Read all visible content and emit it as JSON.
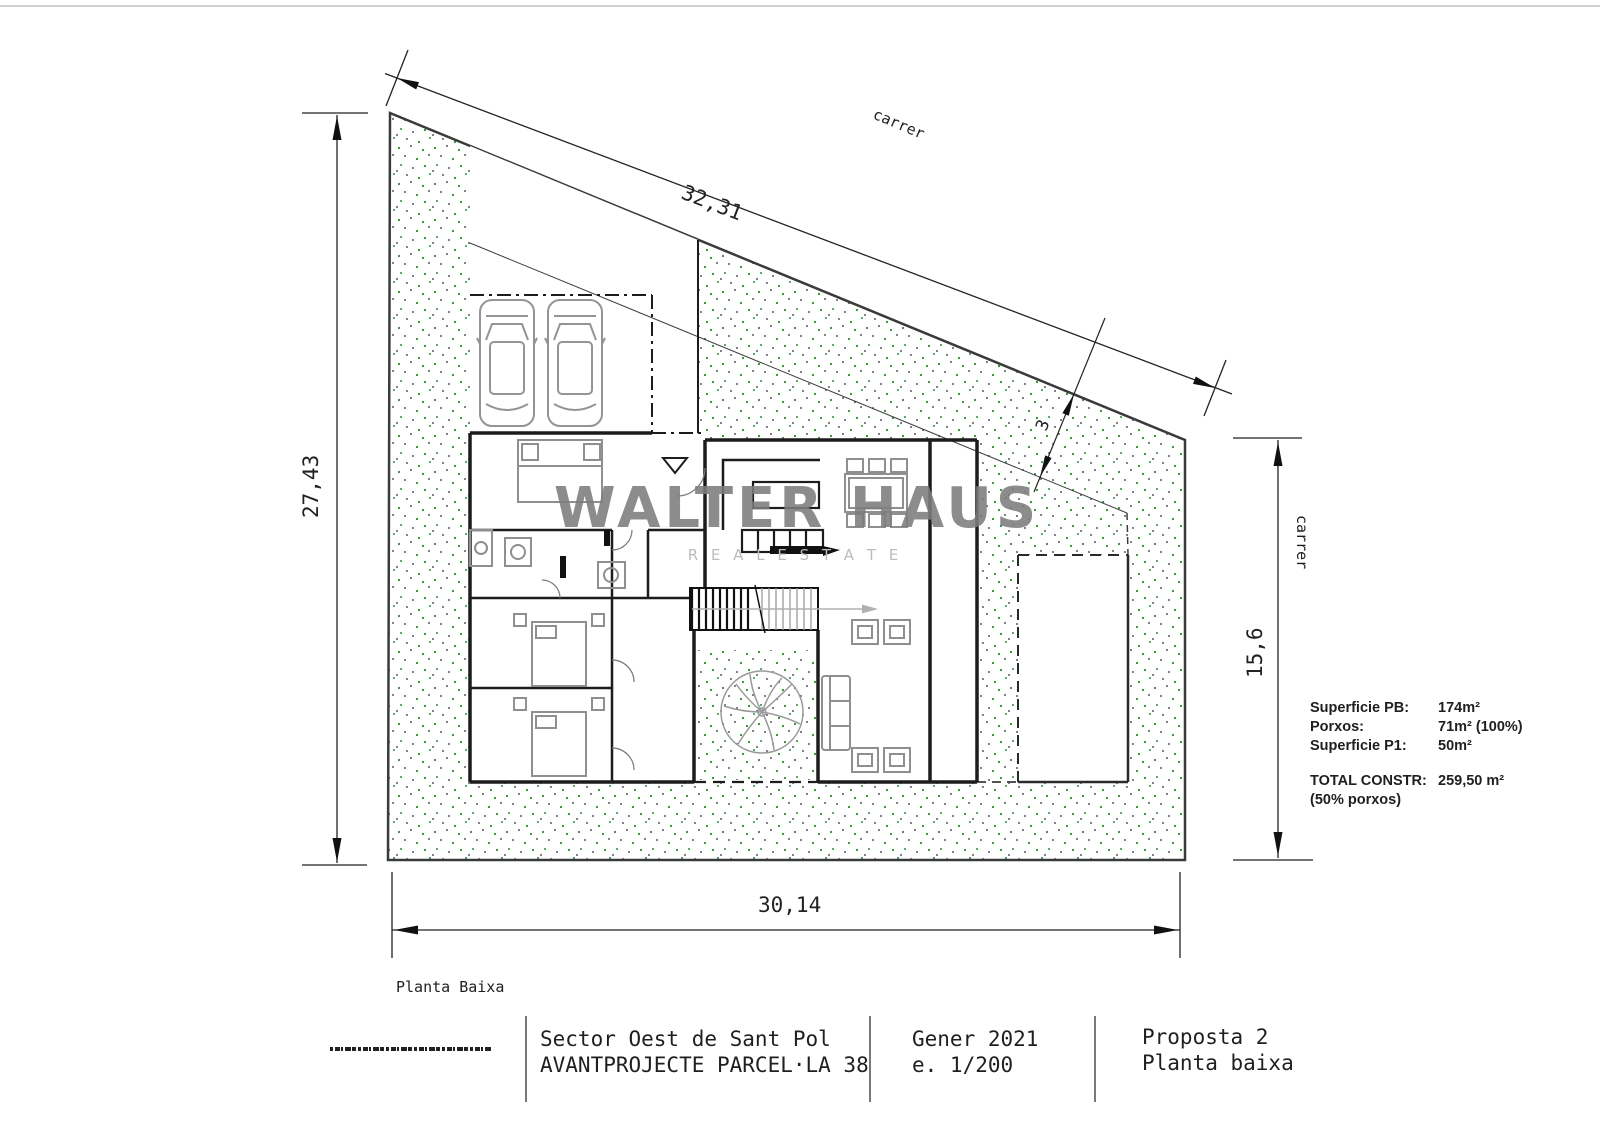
{
  "drawing": {
    "dimensions": {
      "top_diagonal": "32,31",
      "left_vertical": "27,43",
      "bottom_horizontal": "30,14",
      "right_vertical": "15,6",
      "street_setback": "3"
    },
    "labels": {
      "street_top": "carrer",
      "street_right": "carrer",
      "floor_label": "Planta Baixa"
    },
    "watermark": {
      "line1": "WALTER HAUS",
      "line2": "R E A L   E S T A T E"
    },
    "area_table": {
      "rows": [
        {
          "label": "Superficie PB:",
          "value": "174m²"
        },
        {
          "label": "Porxos:",
          "value": "71m² (100%)"
        },
        {
          "label": "Superficie P1:",
          "value": "50m²"
        }
      ],
      "total_label": "TOTAL CONSTR:",
      "total_value": "259,50 m²",
      "total_note": "(50% porxos)"
    },
    "title_block": {
      "project_line1": "Sector Oest de Sant Pol",
      "project_line2": "AVANTPROJECTE PARCEL·LA 38",
      "date": "Gener 2021",
      "scale": "e. 1/200",
      "proposal": "Proposta 2",
      "sheet": "Planta baixa"
    },
    "colors": {
      "stipple_green": "#2e8b2e",
      "stipple_gray": "#5a5a5a",
      "wall_black": "#1c1c1c",
      "furniture_gray": "#8f8f8f",
      "watermark_gray": "#7d7d7d"
    }
  }
}
